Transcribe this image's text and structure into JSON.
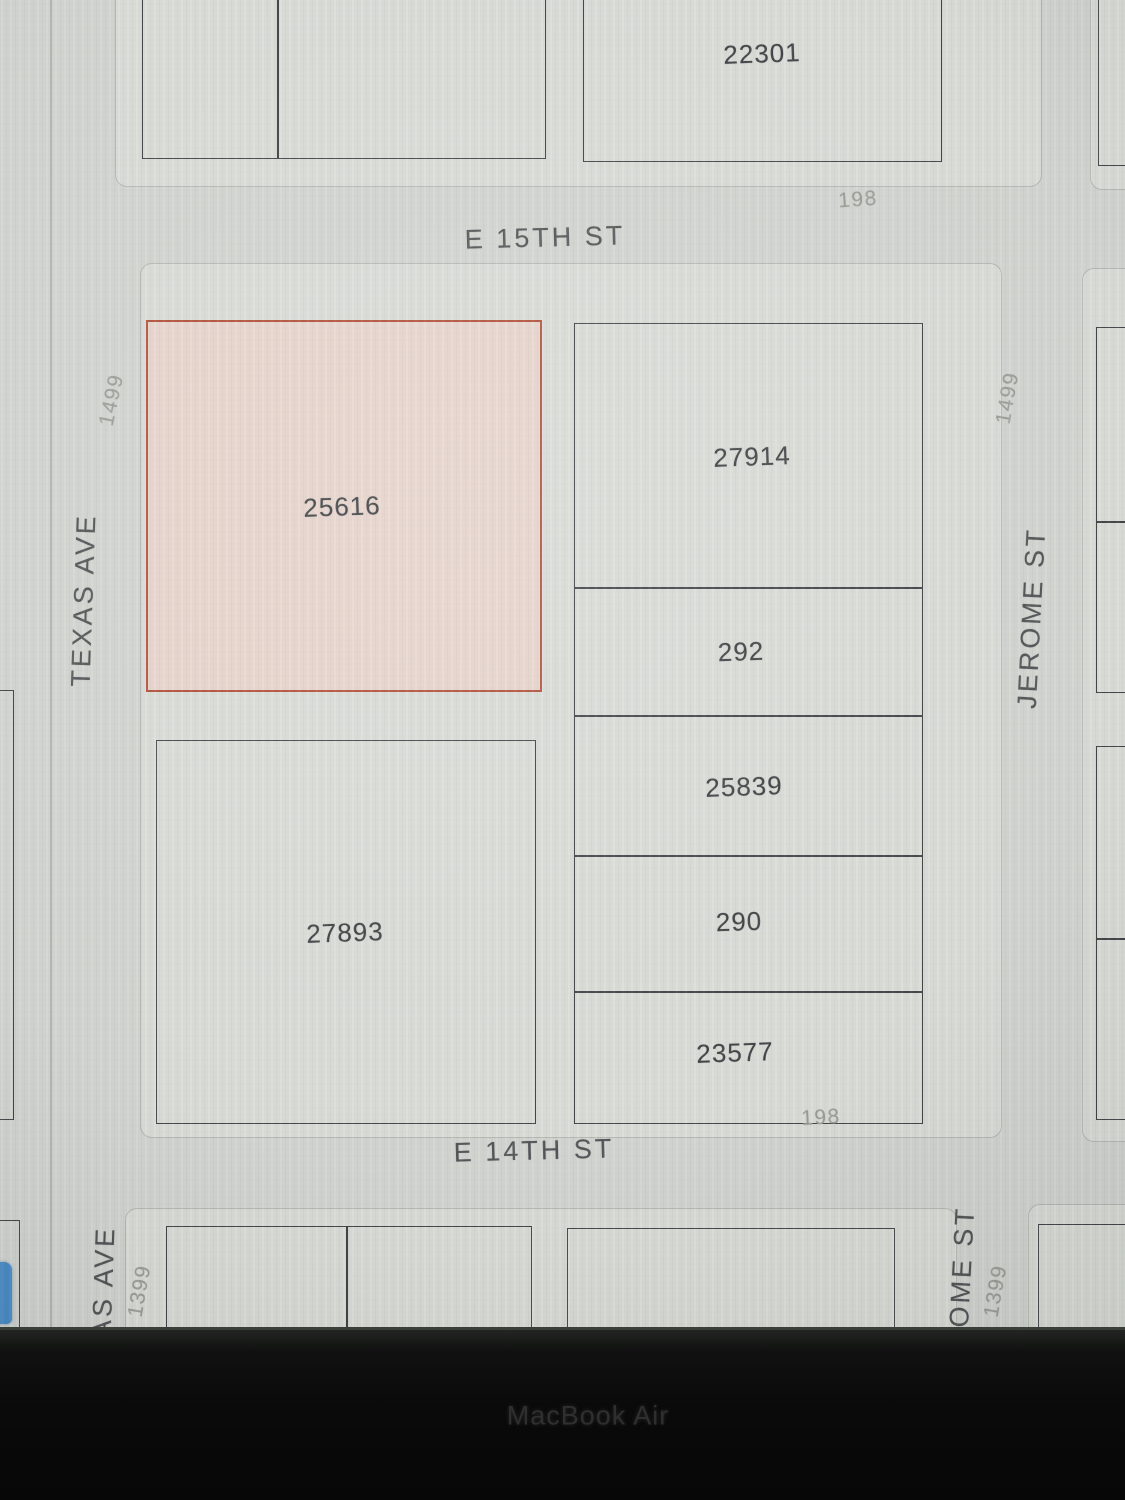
{
  "device": {
    "bezel_label": "MacBook Air"
  },
  "map": {
    "streets": {
      "e_15th": "E 15TH ST",
      "e_14th": "E 14TH ST",
      "texas_ave": "TEXAS AVE",
      "jerome_st": "JEROME ST",
      "texas_ave_clipped": "AS AVE",
      "jerome_st_clipped": "ROME ST"
    },
    "dimensions": {
      "block_198_north": "198",
      "block_198_south": "198",
      "range_1499_west": "1499",
      "range_1499_east": "1499",
      "range_1399_west": "1399",
      "range_1399_east": "1399"
    },
    "parcels": {
      "lot_22301": {
        "label": "22301"
      },
      "lot_25616": {
        "label": "25616",
        "highlighted": true
      },
      "lot_27914": {
        "label": "27914"
      },
      "lot_292": {
        "label": "292"
      },
      "lot_25839": {
        "label": "25839"
      },
      "lot_290": {
        "label": "290"
      },
      "lot_23577": {
        "label": "23577"
      },
      "lot_27893": {
        "label": "27893"
      }
    },
    "colors": {
      "street_bg": "#d2d4d0",
      "block_fill": "#dadcd7",
      "parcel_outline": "#383b3e",
      "highlight_fill": "#e9d4cc",
      "highlight_border": "#b0452e",
      "parcel_text": "#35373a",
      "street_text": "#4a4b4e",
      "dimension_text": "#989a92",
      "bezel": "#0a0a0a",
      "blue_fragment": "#4286c6"
    }
  }
}
